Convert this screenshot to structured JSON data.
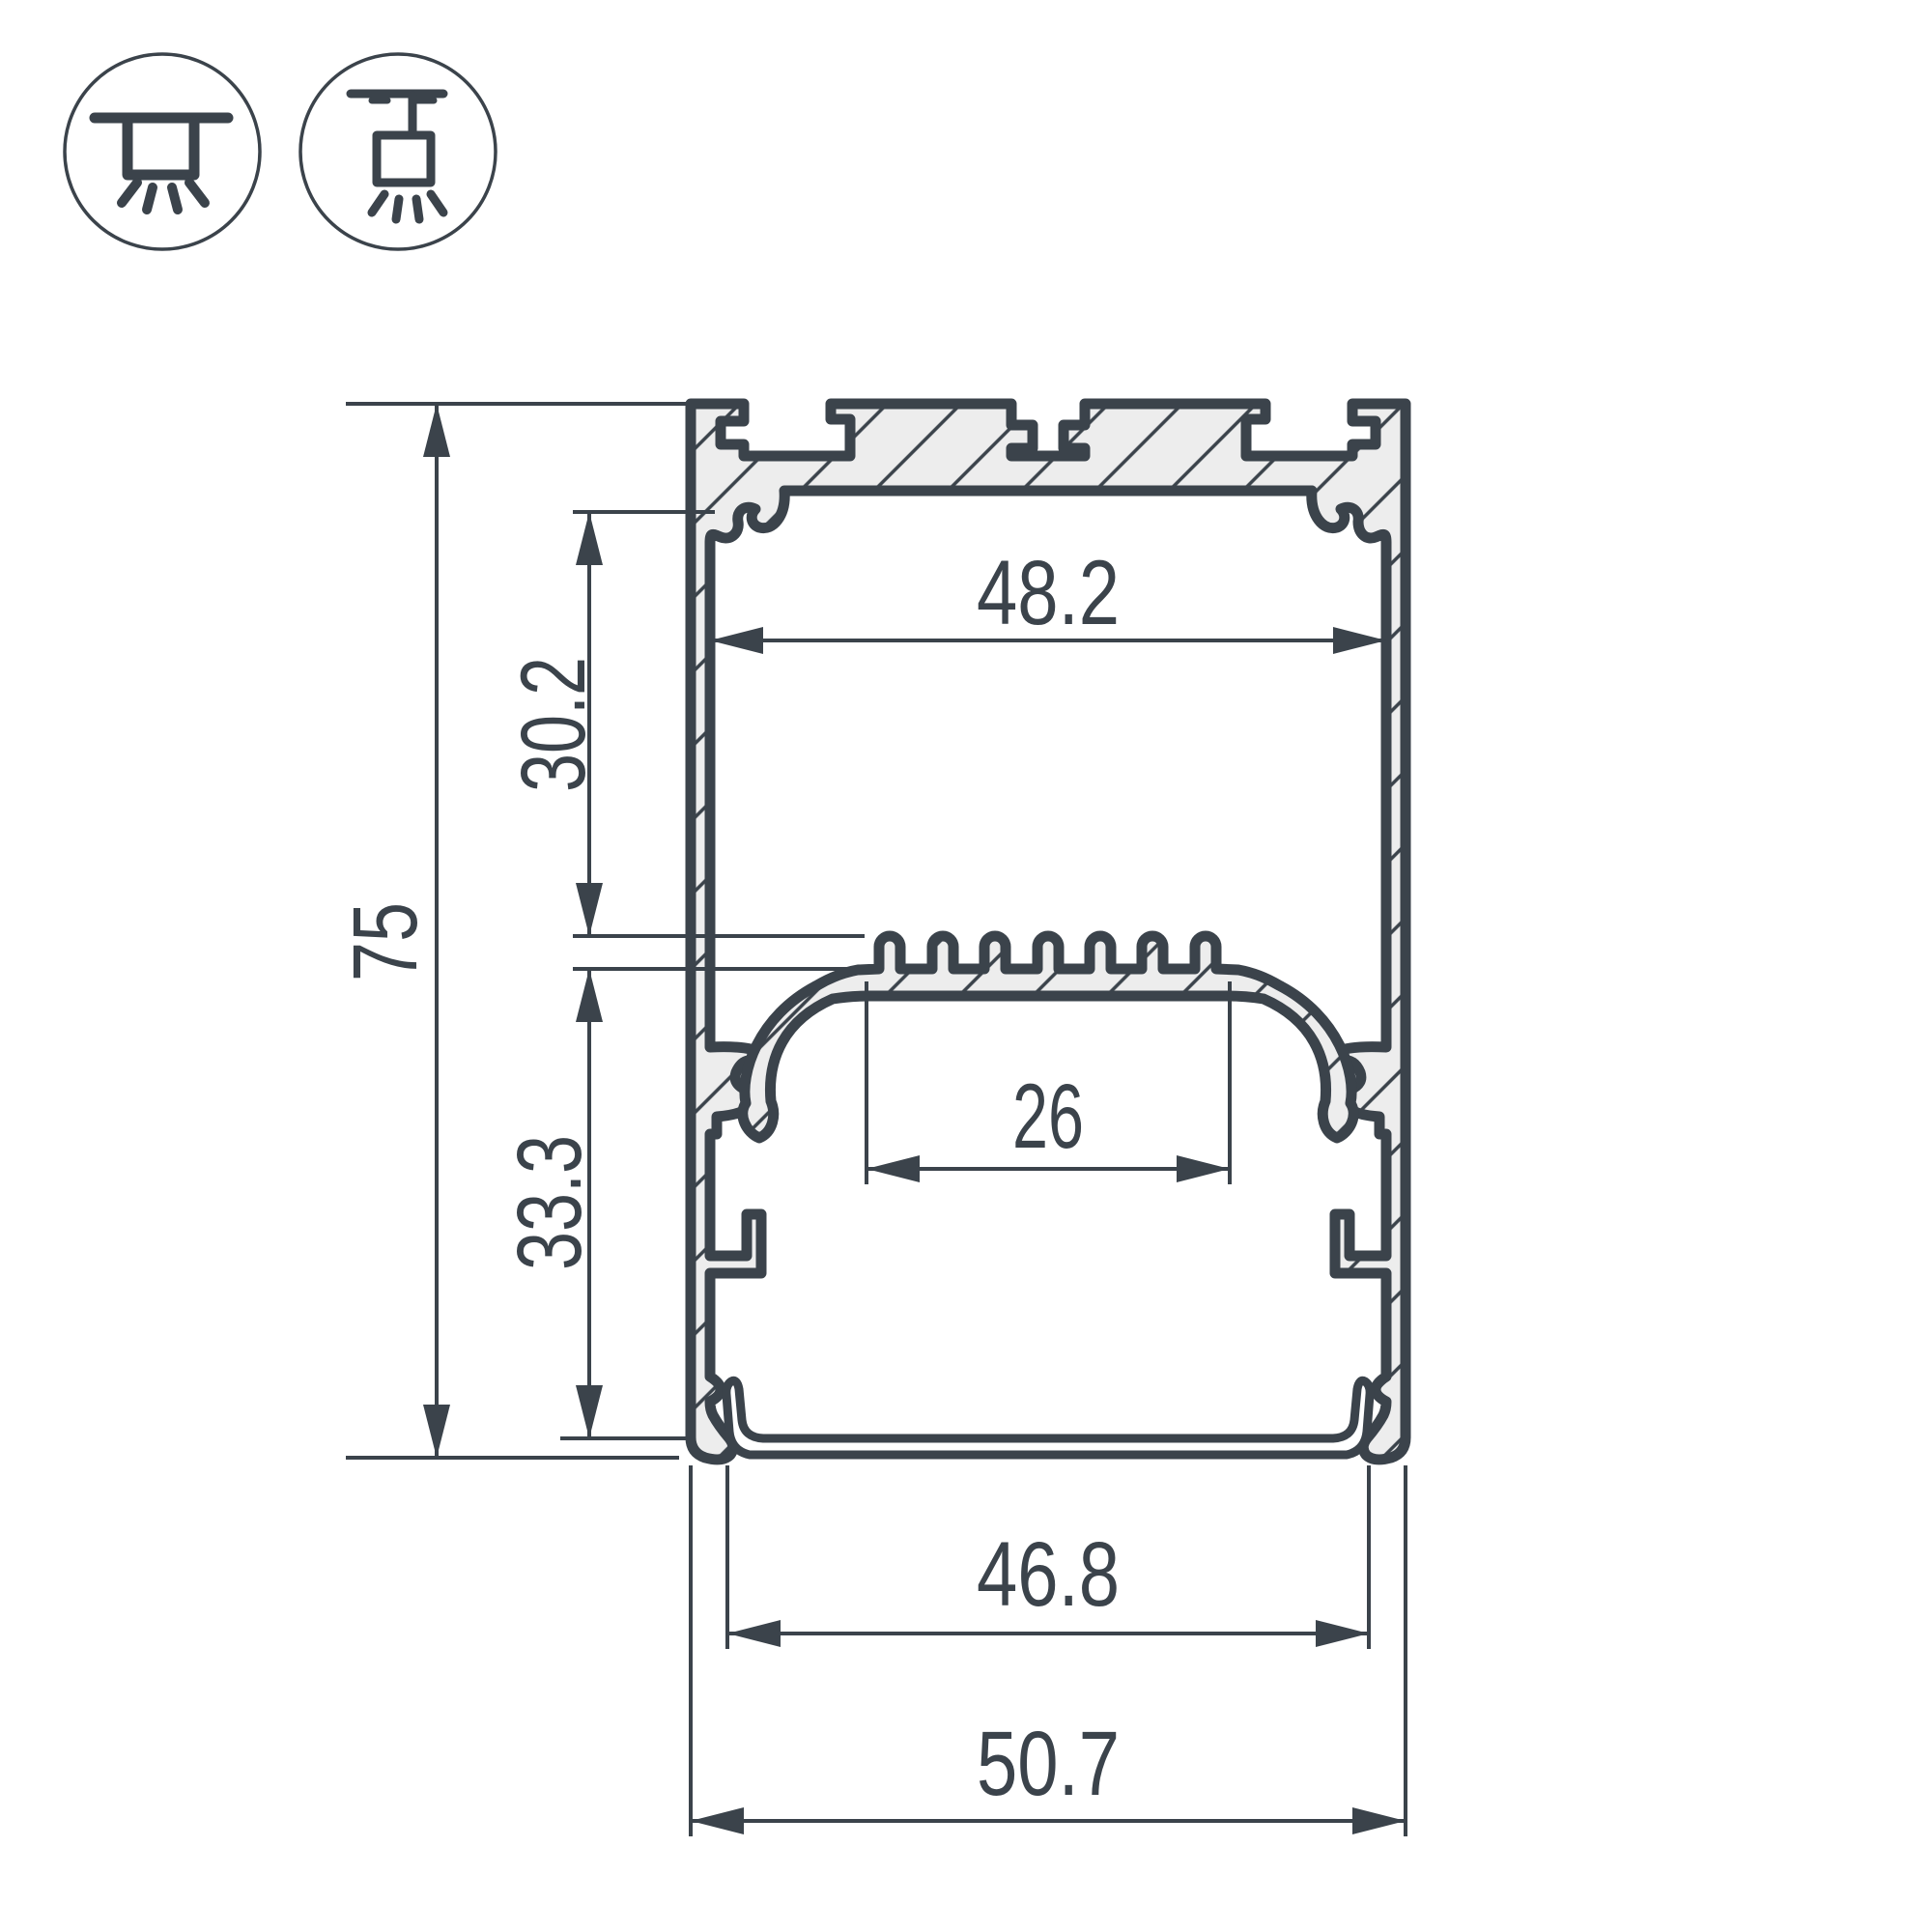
{
  "drawing": {
    "type": "led-profile-cross-section",
    "colors": {
      "ink": "#3B434B",
      "metal_fill": "#EDEDED",
      "background": "#FFFFFF"
    },
    "mounting_icons": [
      {
        "name": "surface-mount-icon"
      },
      {
        "name": "pendant-mount-icon"
      }
    ],
    "dimensions": {
      "overall_height": "75",
      "overall_width": "50.7",
      "inner_width": "48.2",
      "upper_chamber_depth": "30.2",
      "lower_chamber_depth": "33.3",
      "led_shelf_width": "26",
      "bottom_opening_width": "46.8"
    }
  }
}
